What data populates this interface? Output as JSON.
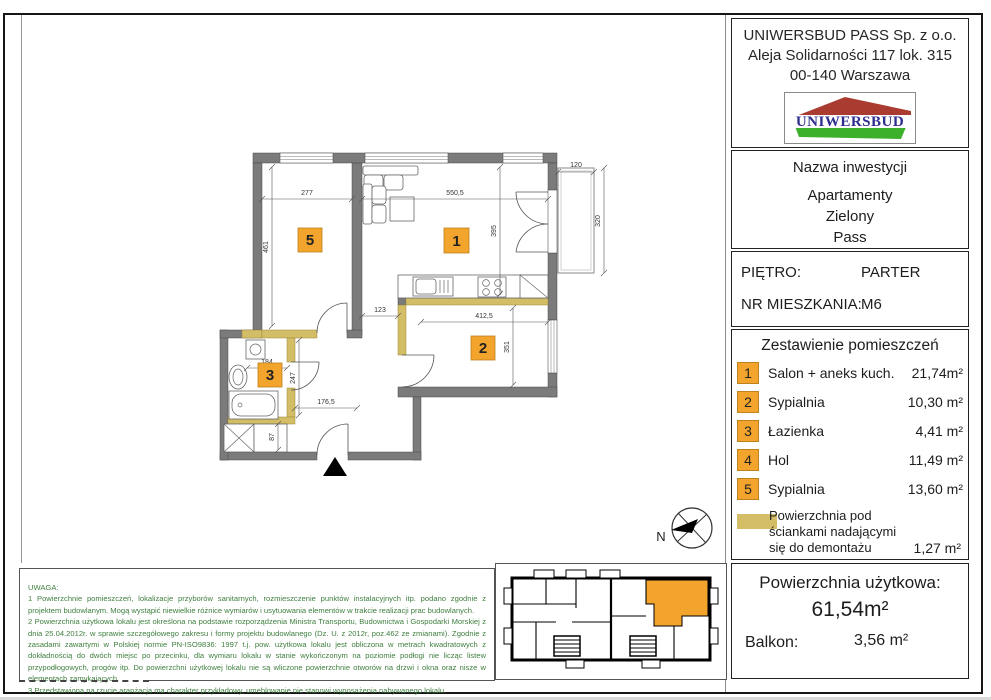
{
  "company": {
    "name": "UNIWERSBUD PASS Sp. z o.o.",
    "address1": "Aleja Solidarności 117 lok. 315",
    "address2": "00-140 Warszawa",
    "logo_text": "UNIWERSBUD"
  },
  "investment": {
    "label": "Nazwa inwestycji",
    "line1": "Apartamenty",
    "line2": "Zielony",
    "line3": "Pass"
  },
  "unit": {
    "floor_label": "PIĘTRO:",
    "floor_value": "PARTER",
    "apt_label": "NR MIESZKANIA:",
    "apt_value": "M6"
  },
  "room_table": {
    "title": "Zestawienie pomieszczeń",
    "rows": [
      {
        "no": "1",
        "name": "Salon + aneks kuch.",
        "area": "21,74m²"
      },
      {
        "no": "2",
        "name": "Sypialnia",
        "area": "10,30 m²"
      },
      {
        "no": "3",
        "name": "Łazienka",
        "area": "4,41 m²"
      },
      {
        "no": "4",
        "name": "Hol",
        "area": "11,49 m²"
      },
      {
        "no": "5",
        "name": "Sypialnia",
        "area": "13,60 m²"
      }
    ]
  },
  "legend": {
    "line1": "Powierzchnia pod",
    "line2": "ściankami nadającymi",
    "line3": "się do demontażu",
    "area": "1,27 m²"
  },
  "summary": {
    "usable_label": "Powierzchnia użytkowa:",
    "usable_value": "61,54m²",
    "balcony_label": "Balkon:",
    "balcony_value": "3,56 m²"
  },
  "notes": {
    "title": "UWAGA:",
    "n1": "1 Powierzchnie pomieszczeń, lokalizacje przyborów sanitarnych, rozmieszczenie punktów instalacyjnych itp. podano zgodnie z projektem budowlanym. Mogą wystąpić niewielkie różnice wymiarów i usytuowania elementów w trakcie realizacji prac budowlanych.",
    "n2": "2 Powierzchnia użytkowa lokalu jest określona na podstawie rozporządzenia Ministra Transportu, Budownictwa i Gospodarki Morskiej z dnia 25.04.2012r. w sprawie szczegółowego zakresu i formy projektu budowlanego (Dz. U. z 2012r, poz.462 ze zmianami). Zgodnie z zasadami zawartymi w Polskiej normie PN-ISO9836: 1997 t.j. pow. użytkowa lokalu jest obliczona w metrach kwadratowych z dokładnością do dwóch miejsc po przecinku, dla wymiaru lokalu w stanie wykończonym na poziomie podłogi nie licząc listew przypodłogowych, progów itp. Do powierzchni użytkowej lokalu nie są wliczone powierzchnie otworów na drzwi i okna oraz nisze w elementach zamykających.",
    "n3": "3 Przedstawiona na rzucie aranżacja ma charakter przykładowy, umeblowanie nie stanowi wyposażenia nabywanego lokalu."
  },
  "plan": {
    "labels": {
      "r1": "1",
      "r2": "2",
      "r3": "3",
      "r5": "5"
    },
    "dims": {
      "w5": "277",
      "h5": "461",
      "w1": "550,5",
      "h1": "395",
      "balc_w": "120",
      "balc_h": "320",
      "pass": "123",
      "w2": "412,5",
      "h2": "351",
      "bath_w": "184",
      "bath_h": "247",
      "hall_w": "176,5",
      "hall_h": "87"
    },
    "compass": "N"
  },
  "colors": {
    "accent_orange": "#f2a42c",
    "wall_gray": "#7b7b7b",
    "demolish_yellow": "#d3bd66",
    "notes_green": "#3f7f3f",
    "logo_navy": "#2d2d8e",
    "logo_red": "#a93b30",
    "logo_green": "#3cb02a"
  }
}
